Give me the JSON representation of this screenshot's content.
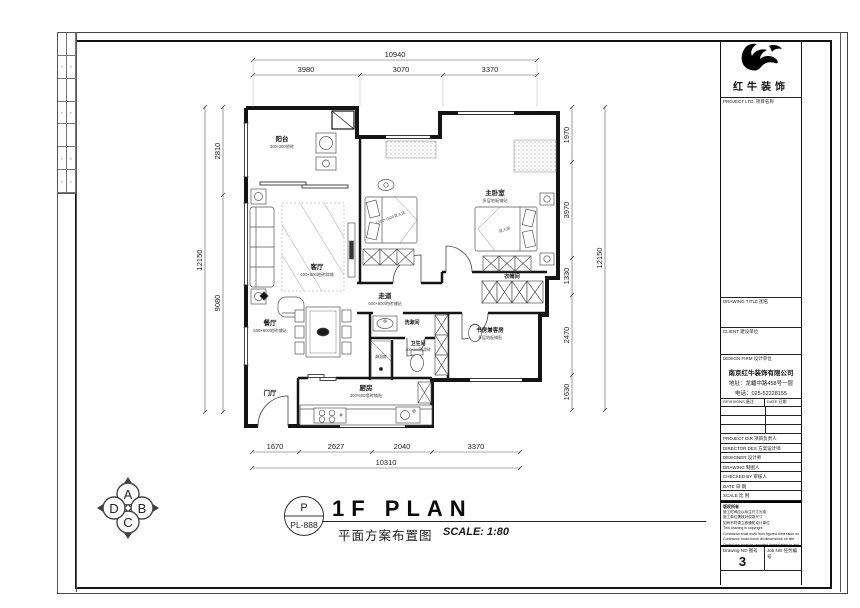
{
  "rooms": {
    "balcony": {
      "name": "阳台",
      "sub": "300*300地砖"
    },
    "living": {
      "name": "客厅",
      "sub": "600×600地砖斜铺"
    },
    "master": {
      "name": "主卧室",
      "sub": "多层地板铺贴"
    },
    "corridor": {
      "name": "走道",
      "sub": "600×600地砖铺贴"
    },
    "cloakroom": {
      "name": "衣帽间"
    },
    "dining": {
      "name": "餐厅",
      "sub": "600×600地砖铺贴"
    },
    "washroom": {
      "name": "洗漱间"
    },
    "bathroom": {
      "name": "卫生间",
      "sub": "300*300防滑砖"
    },
    "shower": {
      "name": "淋浴房"
    },
    "study": {
      "name": "书房兼客房",
      "sub": "多层地板铺贴"
    },
    "kitchen": {
      "name": "厨房",
      "sub": "300*600墙砖铺贴"
    },
    "entry": {
      "name": "门厅"
    },
    "bed2_label": "1500*1900双人床",
    "master_bed_label": "双人床"
  },
  "dims": {
    "top_total": "10940",
    "top": [
      "3980",
      "3070",
      "3370"
    ],
    "left_total": "12150",
    "left": [
      "2810",
      "9080"
    ],
    "right_total": "12150",
    "right": [
      "1970",
      "3970",
      "1330",
      "2470",
      "1630"
    ],
    "bottom_total": "10310",
    "bottom": [
      "1670",
      "2627",
      "2040",
      "3370"
    ]
  },
  "titlebar": {
    "tag_top": "P",
    "tag_code": "PL-888",
    "title": "1F PLAN",
    "subtitle": "平面方案布置图",
    "scale": "SCALE: 1:80"
  },
  "compass": {
    "top": "A",
    "right": "B",
    "bottom": "C",
    "left": "D"
  },
  "titleblock": {
    "logo_text": "红牛装饰",
    "project_label": "PROJECT LTD.  项目名称",
    "drawing_title_label": "DRAWING TITLE  图名",
    "client_label": "CLIENT  建设单位",
    "design_firm_label": "DESIGN FIRM  设计单位",
    "firm_name": "南京红牛装饰有限公司",
    "firm_addr": "地址：龙蟠中路458号一层",
    "firm_tel": "电话：025-52228155",
    "revisions_label": "REVISIONS  备注",
    "date_col_label": "DATE  日期",
    "fields": [
      "PROJECT DIR  项目负责人",
      "DIRECTOR DES  方案设计师",
      "DESIGNER   设计师",
      "DRAWING   制图人",
      "CHECKED BY   审核人",
      "DATE   日  期",
      "SCALE   比  例"
    ],
    "notes_title": "版权所有",
    "notes": [
      "施工时间应以标注尺寸为准",
      "施工单位需核对现场尺寸",
      "如有不符请立即通知设计单位",
      "This drawing is copyright",
      "Contractor shall work from figured dimension only",
      "Contractor must check all dimensions on site",
      "Omissions must be reported immediately to architect"
    ],
    "drawing_no_label": "Drawing NO  图号",
    "drawing_no": "3",
    "job_no_label": "Job NO  任务编号"
  }
}
